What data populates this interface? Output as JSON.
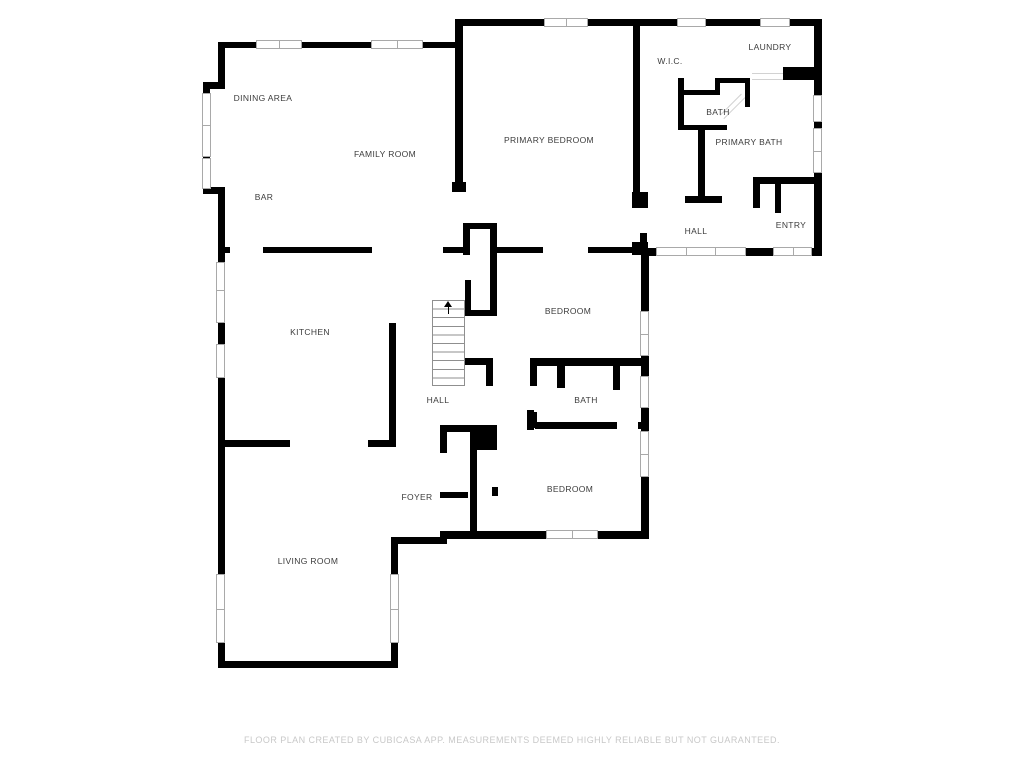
{
  "plan": {
    "type": "floor-plan",
    "rooms": {
      "dining_area": {
        "label": "DINING AREA"
      },
      "family_room": {
        "label": "FAMILY ROOM"
      },
      "bar": {
        "label": "BAR"
      },
      "primary_bedroom": {
        "label": "PRIMARY BEDROOM"
      },
      "wic": {
        "label": "W.I.C."
      },
      "laundry": {
        "label": "LAUNDRY"
      },
      "bath_upper": {
        "label": "BATH"
      },
      "primary_bath": {
        "label": "PRIMARY BATH"
      },
      "hall_upper": {
        "label": "HALL"
      },
      "entry": {
        "label": "ENTRY"
      },
      "kitchen": {
        "label": "KITCHEN"
      },
      "bedroom_middle": {
        "label": "BEDROOM"
      },
      "bath_middle": {
        "label": "BATH"
      },
      "hall_middle": {
        "label": "HALL"
      },
      "foyer": {
        "label": "FOYER"
      },
      "bedroom_lower": {
        "label": "BEDROOM"
      },
      "living_room": {
        "label": "LIVING ROOM"
      }
    },
    "footer": "FLOOR PLAN CREATED BY CUBICASA APP. MEASUREMENTS DEEMED HIGHLY RELIABLE BUT NOT GUARANTEED.",
    "colors": {
      "wall": "#000000",
      "window_outline": "#a9a9a9",
      "label_text": "#3c3c3c",
      "footer_text": "#c8c8c8",
      "background": "#ffffff"
    }
  }
}
